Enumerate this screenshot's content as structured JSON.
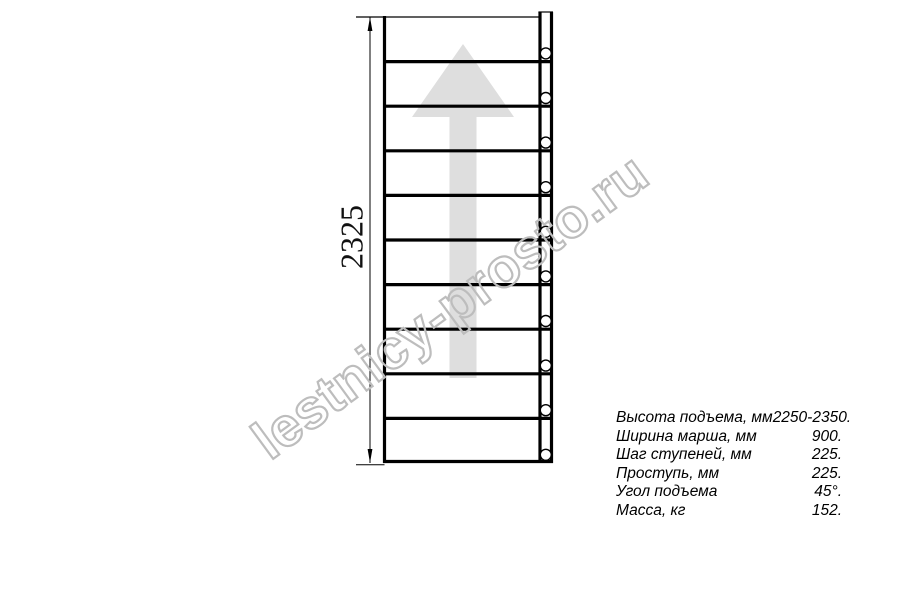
{
  "figure": {
    "dimension_label": "2325",
    "steps": 10,
    "geometry": {
      "top": 17,
      "bottom": 463,
      "plan_left": 383,
      "plan_right": 553,
      "left_edge_x": 384.5,
      "right_inner_x": 540,
      "right_outer_x": 551.5,
      "stringer_top": 12,
      "dim_x": 370,
      "ext_left": 356,
      "dim_text_x": 362.5,
      "dim_text_y": 237,
      "circle_cx": 545.8,
      "circle_r": 5.5,
      "circle_offset": 8.2,
      "arrow": {
        "cx": 463,
        "tip_y": 44,
        "head_base_y": 117,
        "head_half_width": 51,
        "shaft_half_width": 13.5,
        "shaft_bottom": 378
      }
    },
    "colors": {
      "line": "#000000",
      "arrow_fill": "#dedede",
      "circle_fill": "#ffffff",
      "dim_text": "#111111"
    }
  },
  "watermark": {
    "text": "lestnicy-prosto.ru"
  },
  "specs": {
    "rows": [
      {
        "label": "Высота подъема, мм",
        "value": "2250-2350."
      },
      {
        "label": "Ширина марша, мм",
        "value": "900."
      },
      {
        "label": "Шаг ступеней, мм",
        "value": "225."
      },
      {
        "label": "Проступь, мм",
        "value": "225."
      },
      {
        "label": "Угол подъема",
        "value": "45°."
      },
      {
        "label": "Масса, кг",
        "value": "152."
      }
    ]
  }
}
